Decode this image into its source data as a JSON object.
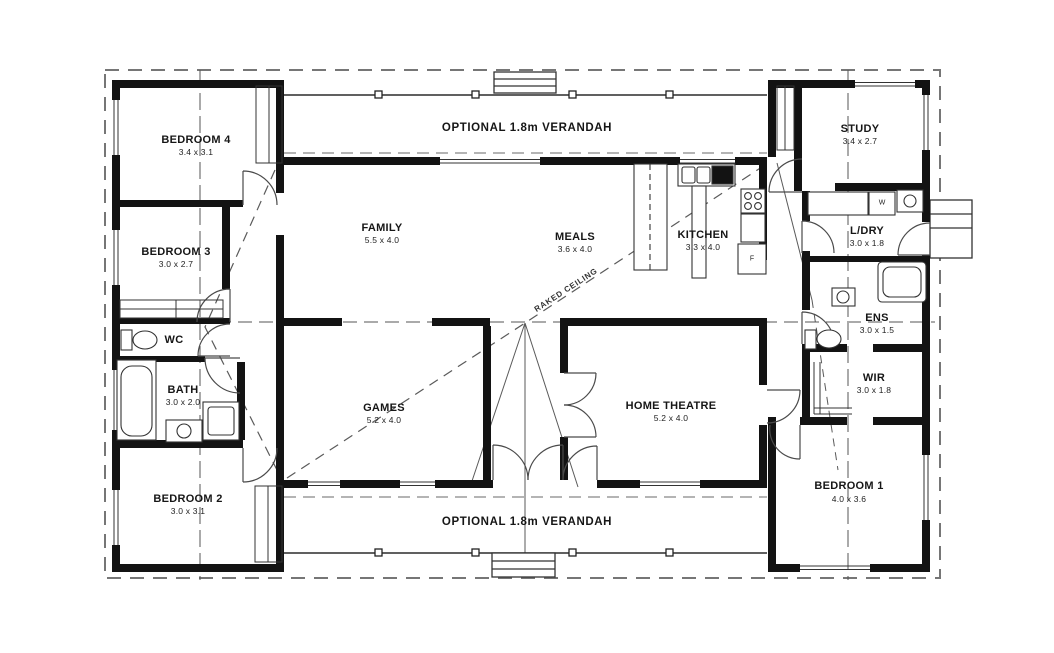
{
  "plan": {
    "verandah_top": "OPTIONAL 1.8m VERANDAH",
    "verandah_bottom": "OPTIONAL 1.8m VERANDAH",
    "raked_ceiling": "RAKED CEILING",
    "rooms": {
      "bedroom4": {
        "name": "BEDROOM 4",
        "dims": "3.4 x 3.1"
      },
      "bedroom3": {
        "name": "BEDROOM 3",
        "dims": "3.0 x 2.7"
      },
      "wc": {
        "name": "WC"
      },
      "bath": {
        "name": "BATH",
        "dims": "3.0 x 2.0"
      },
      "bedroom2": {
        "name": "BEDROOM 2",
        "dims": "3.0 x 3.1"
      },
      "family": {
        "name": "FAMILY",
        "dims": "5.5 x 4.0"
      },
      "meals": {
        "name": "MEALS",
        "dims": "3.6 x 4.0"
      },
      "kitchen": {
        "name": "KITCHEN",
        "dims": "3.3 x 4.0"
      },
      "games": {
        "name": "GAMES",
        "dims": "5.2 x 4.0"
      },
      "home_theatre": {
        "name": "HOME THEATRE",
        "dims": "5.2 x 4.0"
      },
      "study": {
        "name": "STUDY",
        "dims": "3.4 x 2.7"
      },
      "ldry": {
        "name": "L/DRY",
        "dims": "3.0 x 1.8"
      },
      "ens": {
        "name": "ENS",
        "dims": "3.0 x 1.5"
      },
      "wir": {
        "name": "WIR",
        "dims": "3.0 x 1.8"
      },
      "bedroom1": {
        "name": "BEDROOM 1",
        "dims": "4.0 x 3.6"
      }
    },
    "appliances": {
      "washer": "W",
      "fridge": "F"
    }
  }
}
